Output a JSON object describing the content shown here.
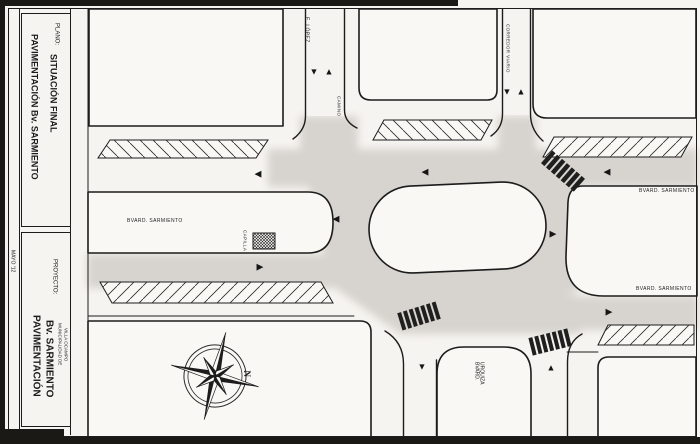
{
  "sheet": {
    "date": "MAYO '12",
    "plano": {
      "label": "PLANO:",
      "title_line1": "PAVIMENTACIÓN Bv. SARMIENTO",
      "title_line2": "SITUACIÓN FINAL"
    },
    "proyecto": {
      "label": "PROYECTO:",
      "title_line1": "PAVIMENTACIÓN",
      "title_line2": "Bv. SARMIENTO",
      "org_line1": "MUNICIPALIDAD DE",
      "org_line2": "VILLA OCAMPO"
    }
  },
  "map": {
    "labels": {
      "street_top_left": "E. LÓPEZ",
      "street_top_left_corner": "CAMINO",
      "street_top_right": "CORREDOR VIARIO",
      "boulevard_west": "BVARD. SARMIENTO",
      "boulevard_east_north": "BVARD. SARMIENTO",
      "boulevard_east_south": "BVARD. SARMIENTO",
      "chapel": "CAPILLA",
      "street_bottom_line1": "BVARD.",
      "street_bottom_line2": "URQUIZA",
      "north": "N"
    },
    "arrow_glyphs": {
      "up": "▲",
      "down": "▼",
      "left": "◀",
      "right": "▶"
    },
    "colors": {
      "paper": "#f6f4f0",
      "ink": "#1c1c1c",
      "road_shading": "#d7d4cf"
    }
  }
}
